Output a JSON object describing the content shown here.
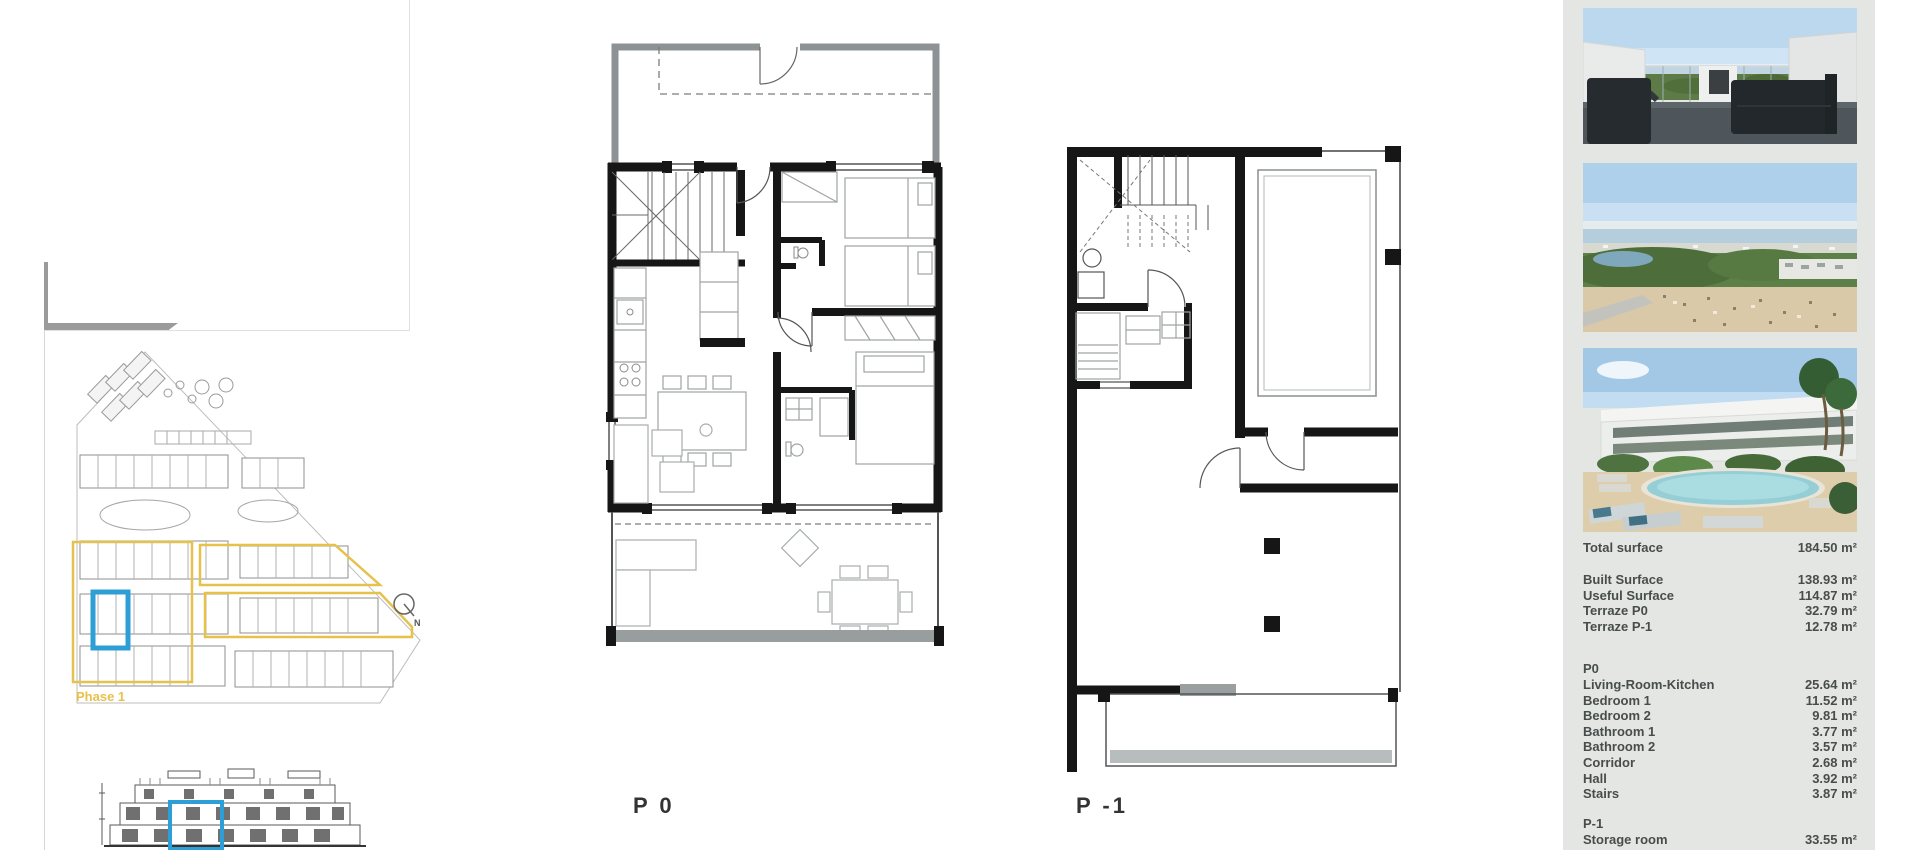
{
  "floor_plans": {
    "p0_label": "P 0",
    "p_minus1_label": "P -1"
  },
  "site_plan": {
    "phase_label": "Phase 1",
    "north_label": "N",
    "phase_outline_color": "#e6c14b",
    "unit_highlight_color": "#2e9fd6"
  },
  "sidebar": {
    "background_color": "#e4e6e4",
    "photos": [
      {
        "name": "terrace-sea-view-render"
      },
      {
        "name": "aerial-coastline-view"
      },
      {
        "name": "pool-and-townhouses-render"
      }
    ],
    "table": {
      "total": {
        "label": "Total surface",
        "value": "184.50 m²"
      },
      "summary": [
        {
          "label": "Built Surface",
          "value": "138.93 m²"
        },
        {
          "label": "Useful Surface",
          "value": "114.87 m²"
        },
        {
          "label": "Terraze P0",
          "value": "32.79 m²"
        },
        {
          "label": "Terraze P-1",
          "value": "12.78 m²"
        }
      ],
      "p0_header": "P0",
      "p0_rows": [
        {
          "label": "Living-Room-Kitchen",
          "value": "25.64 m²"
        },
        {
          "label": "Bedroom 1",
          "value": "11.52 m²"
        },
        {
          "label": "Bedroom 2",
          "value": "9.81 m²"
        },
        {
          "label": "Bathroom 1",
          "value": "3.77 m²"
        },
        {
          "label": "Bathroom 2",
          "value": "3.57 m²"
        },
        {
          "label": "Corridor",
          "value": "2.68 m²"
        },
        {
          "label": "Hall",
          "value": "3.92 m²"
        },
        {
          "label": "Stairs",
          "value": "3.87 m²"
        }
      ],
      "p1_header": "P-1",
      "p1_rows": [
        {
          "label": "Storage room",
          "value": "33.55 m²"
        }
      ]
    }
  }
}
